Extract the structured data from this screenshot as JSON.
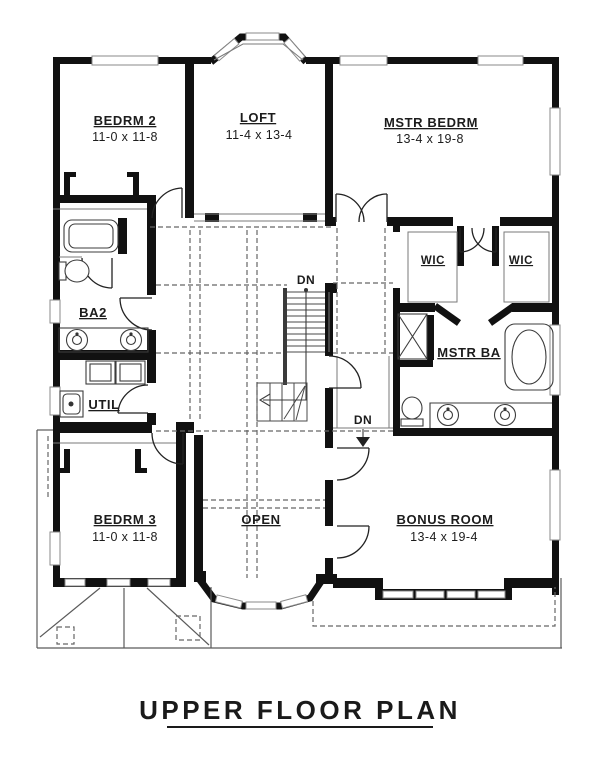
{
  "title": "UPPER FLOOR PLAN",
  "rooms": [
    {
      "id": "bedrm2",
      "name": "BEDRM 2",
      "dims": "11-0 x 11-8"
    },
    {
      "id": "loft",
      "name": "LOFT",
      "dims": "11-4 x 13-4"
    },
    {
      "id": "mstr_bedrm",
      "name": "MSTR BEDRM",
      "dims": "13-4 x 19-8"
    },
    {
      "id": "ba2",
      "name": "BA2"
    },
    {
      "id": "util",
      "name": "UTIL"
    },
    {
      "id": "wic_left",
      "name": "WIC"
    },
    {
      "id": "wic_right",
      "name": "WIC"
    },
    {
      "id": "mstr_ba",
      "name": "MSTR BA"
    },
    {
      "id": "bedrm3",
      "name": "BEDRM 3",
      "dims": "11-0 x 11-8"
    },
    {
      "id": "open",
      "name": "OPEN"
    },
    {
      "id": "bonus",
      "name": "BONUS ROOM",
      "dims": "13-4 x 19-4"
    }
  ],
  "stairs": {
    "down_label_top": "DN",
    "down_label_bottom": "DN"
  },
  "colors": {
    "wall": "#111111",
    "thin_line": "#7a7a7a",
    "dashed_line": "#666666",
    "background": "#ffffff",
    "text": "#1c1c1c"
  }
}
